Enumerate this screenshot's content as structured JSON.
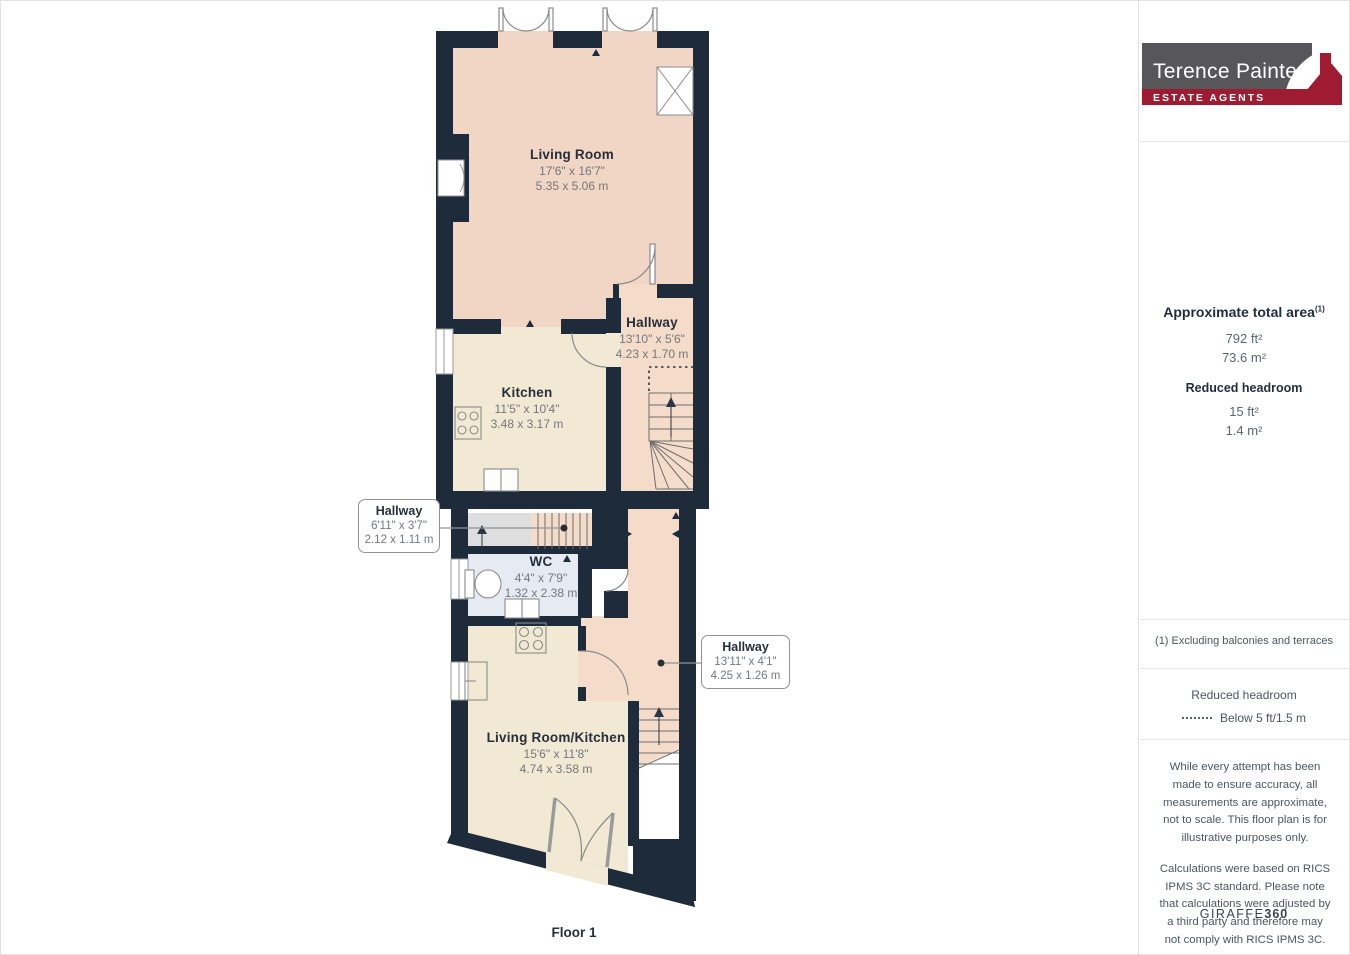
{
  "page": {
    "floor_label": "Floor 1"
  },
  "floorplan": {
    "rooms": [
      {
        "name": "Living Room",
        "imperial": "17'6\" x 16'7\"",
        "metric": "5.35 x 5.06 m"
      },
      {
        "name": "Hallway",
        "imperial": "13'10\" x 5'6\"",
        "metric": "4.23 x 1.70 m"
      },
      {
        "name": "Kitchen",
        "imperial": "11'5\" x 10'4\"",
        "metric": "3.48 x 3.17 m"
      },
      {
        "name": "WC",
        "imperial": "4'4\" x 7'9\"",
        "metric": "1.32 x 2.38 m"
      },
      {
        "name": "Living Room/Kitchen",
        "imperial": "15'6\" x 11'8\"",
        "metric": "4.74 x 3.58 m"
      }
    ],
    "callouts": [
      {
        "name": "Hallway",
        "imperial": "6'11\" x 3'7\"",
        "metric": "2.12 x 1.11 m"
      },
      {
        "name": "Hallway",
        "imperial": "13'11\" x 4'1\"",
        "metric": "4.25 x 1.26 m"
      }
    ]
  },
  "sidebar": {
    "logo": {
      "brand": "Terence Painter",
      "tagline": "ESTATE AGENTS"
    },
    "total_area": {
      "title": "Approximate total area",
      "footnote_marker": "(1)",
      "imperial": "792 ft²",
      "metric": "73.6 m²"
    },
    "reduced_headroom": {
      "title": "Reduced headroom",
      "imperial": "15 ft²",
      "metric": "1.4 m²"
    },
    "footnote": "(1) Excluding balconies and terraces",
    "legend": {
      "title": "Reduced headroom",
      "item": "Below 5 ft/1.5 m"
    },
    "disclaimer_1": "While every attempt has been made to ensure accuracy, all measurements are approximate, not to scale. This floor plan is for illustrative purposes only.",
    "disclaimer_2": "Calculations were based on RICS IPMS 3C standard. Please note that calculations were adjusted by a third party and therefore may not comply with RICS IPMS 3C.",
    "brand_footer": {
      "name": "GIRAFFE",
      "suffix": "360"
    }
  },
  "colors": {
    "wall": "#1e2b3b",
    "room_pink": "#f1d5c5",
    "hall_pink": "#f5dbc9",
    "room_cream": "#f1e9d3",
    "wc_blue": "#e6ebf3",
    "landing_grey": "#dedede",
    "logo_grey": "#57575a",
    "brand_maroon": "#9e1b32"
  }
}
